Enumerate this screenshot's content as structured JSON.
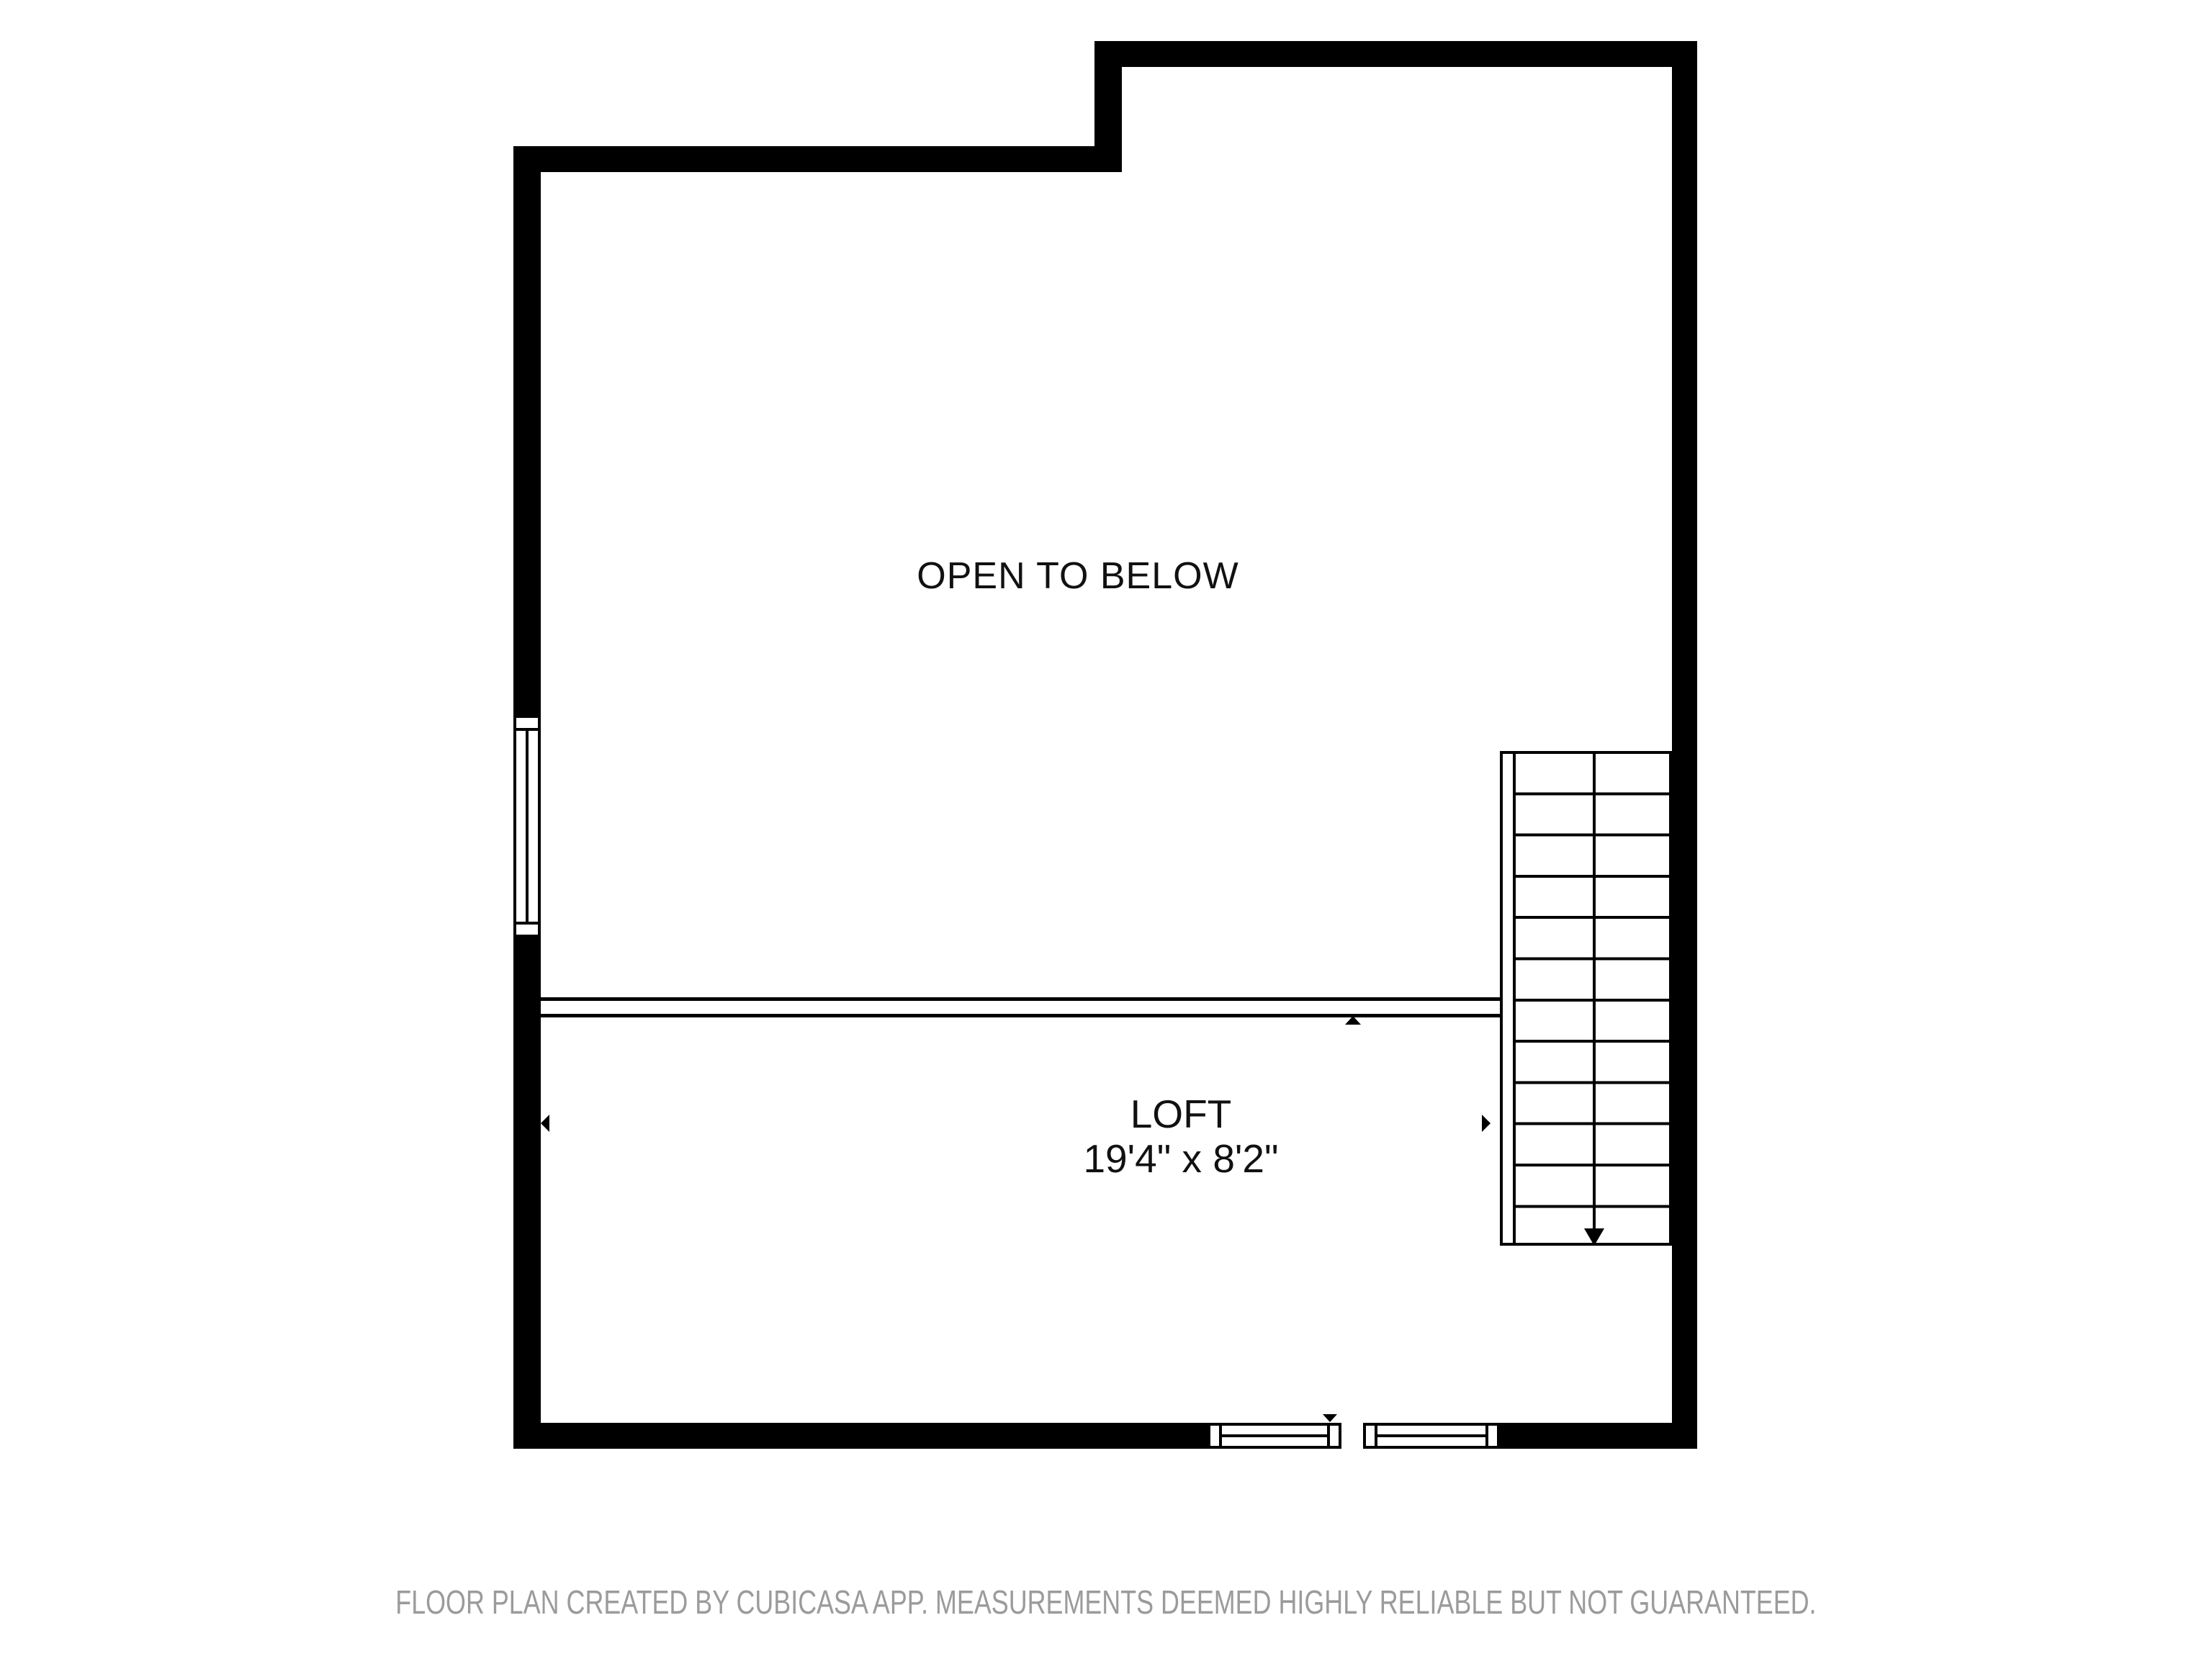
{
  "colors": {
    "wall": "#000000",
    "background": "#ffffff",
    "label_text": "#111111",
    "footer_text": "#9b9b9b"
  },
  "labels": {
    "open_to_below": "OPEN TO BELOW",
    "loft_name": "LOFT",
    "loft_dimensions": "19'4\" x 8'2\""
  },
  "footer": {
    "disclaimer": "FLOOR PLAN CREATED BY CUBICASA APP. MEASUREMENTS DEEMED HIGHLY RELIABLE BUT NOT GUARANTEED."
  }
}
